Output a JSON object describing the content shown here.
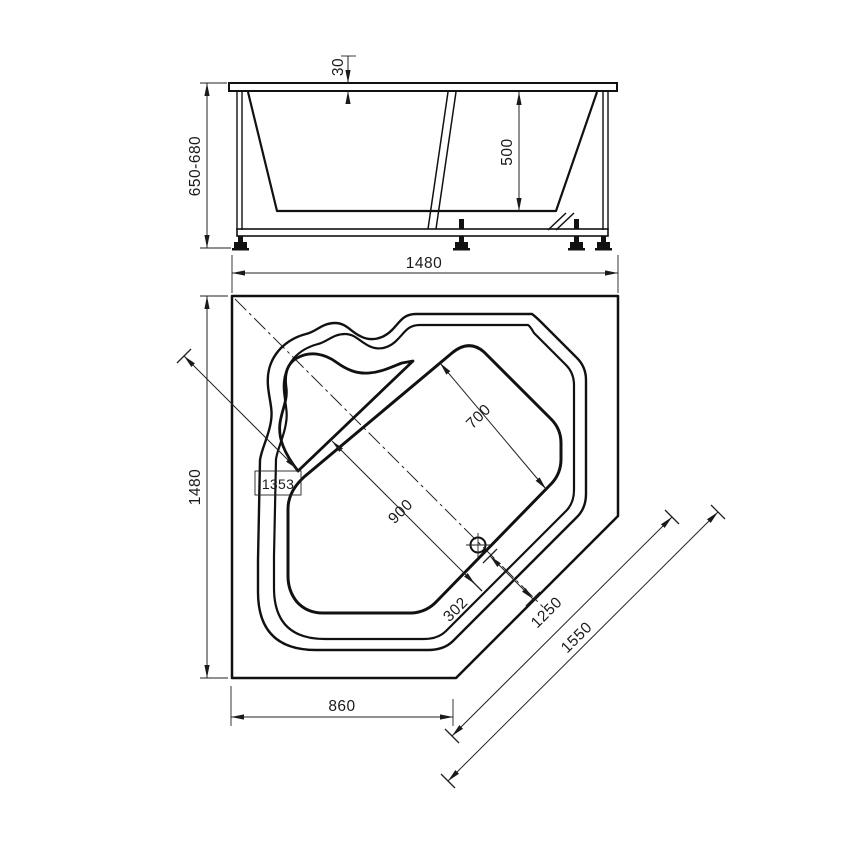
{
  "colors": {
    "line": "#1a1a1a",
    "background": "#ffffff"
  },
  "side_view": {
    "rim_thickness": "30",
    "height_range": "650-680",
    "inner_depth": "500"
  },
  "shared": {
    "overall_width": "1480"
  },
  "plan_view": {
    "overall_depth": "1480",
    "corner_diagonal": "1353",
    "basin_width_diag": "700",
    "basin_length_diag": "900",
    "drain_offset_diag": "302",
    "apron_diagonal_inner": "1250",
    "apron_diagonal_outer": "1550",
    "front_edge_width": "860"
  }
}
